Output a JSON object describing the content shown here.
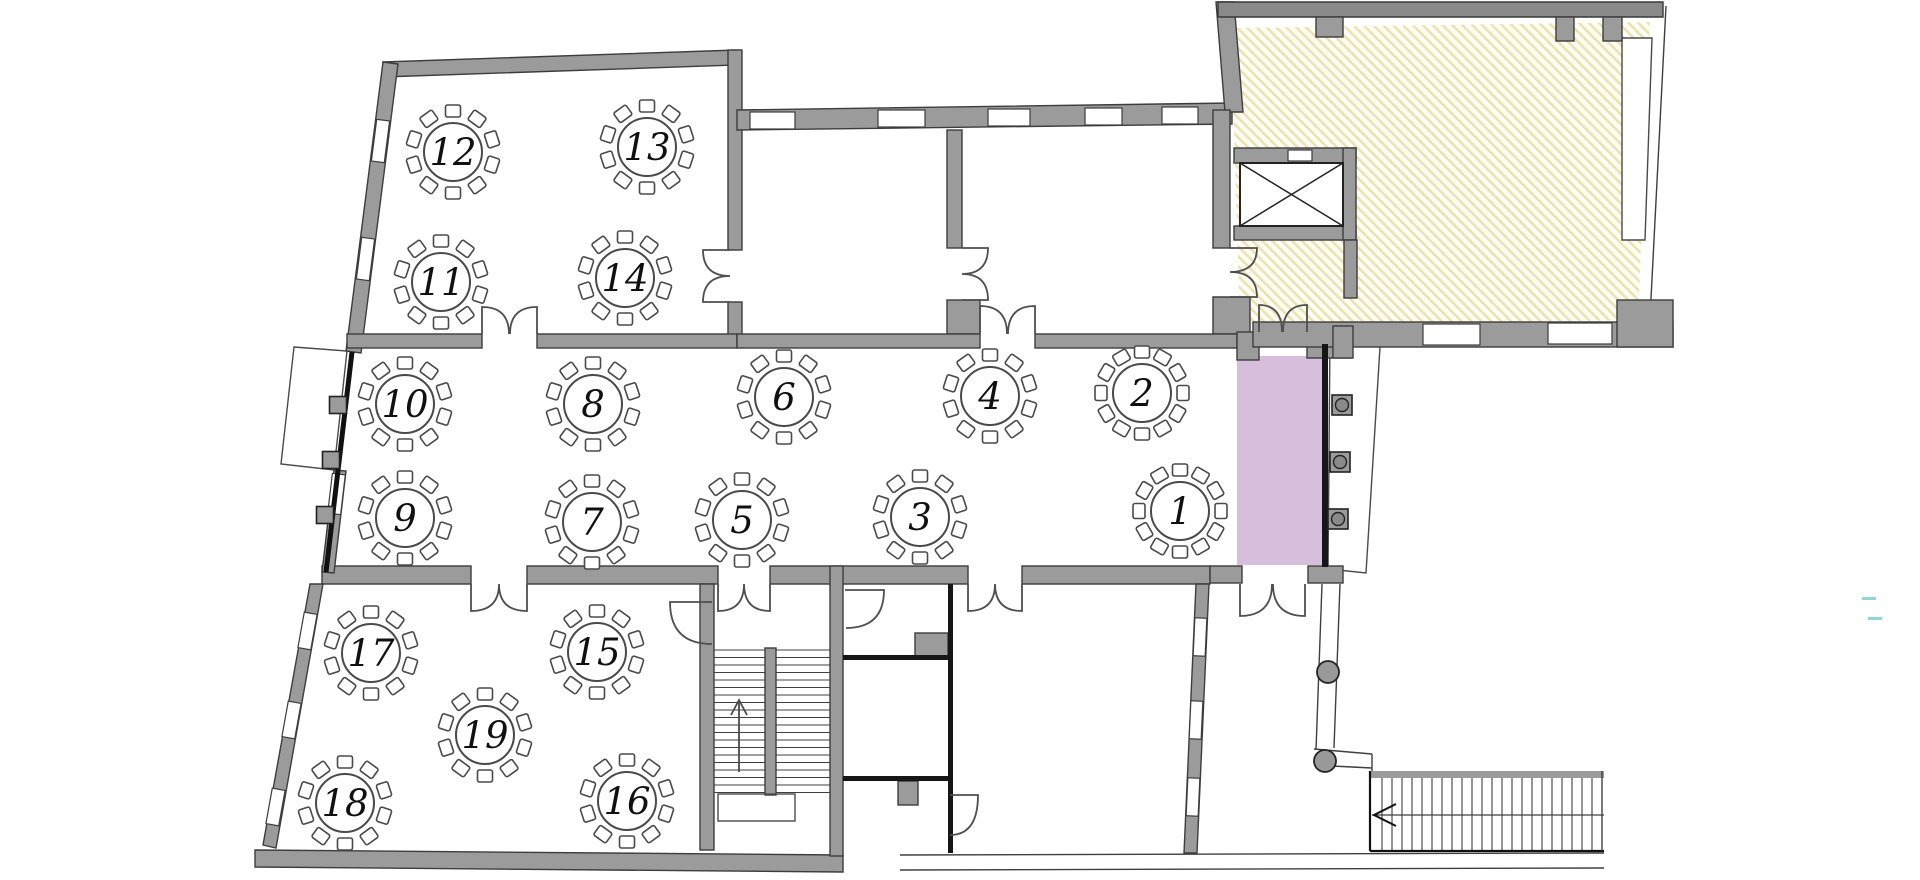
{
  "plan": {
    "tables": [
      {
        "number": "1",
        "x": 1180,
        "y": 511,
        "chairs": 12
      },
      {
        "number": "2",
        "x": 1142,
        "y": 393,
        "chairs": 12
      },
      {
        "number": "3",
        "x": 920,
        "y": 517,
        "chairs": 10
      },
      {
        "number": "4",
        "x": 990,
        "y": 396,
        "chairs": 10
      },
      {
        "number": "5",
        "x": 742,
        "y": 520,
        "chairs": 10
      },
      {
        "number": "6",
        "x": 784,
        "y": 397,
        "chairs": 10
      },
      {
        "number": "7",
        "x": 592,
        "y": 522,
        "chairs": 10
      },
      {
        "number": "8",
        "x": 593,
        "y": 404,
        "chairs": 10
      },
      {
        "number": "9",
        "x": 405,
        "y": 518,
        "chairs": 10
      },
      {
        "number": "10",
        "x": 405,
        "y": 404,
        "chairs": 10
      },
      {
        "number": "11",
        "x": 441,
        "y": 282,
        "chairs": 10
      },
      {
        "number": "12",
        "x": 453,
        "y": 152,
        "chairs": 10
      },
      {
        "number": "13",
        "x": 647,
        "y": 147,
        "chairs": 10
      },
      {
        "number": "14",
        "x": 625,
        "y": 278,
        "chairs": 10
      },
      {
        "number": "15",
        "x": 597,
        "y": 652,
        "chairs": 10
      },
      {
        "number": "16",
        "x": 627,
        "y": 801,
        "chairs": 10
      },
      {
        "number": "17",
        "x": 371,
        "y": 653,
        "chairs": 10
      },
      {
        "number": "18",
        "x": 345,
        "y": 803,
        "chairs": 10
      },
      {
        "number": "19",
        "x": 485,
        "y": 735,
        "chairs": 10
      }
    ],
    "highlight_zone": {
      "color": "#d8bedd"
    },
    "colors": {
      "wall": "#9b9b9b",
      "wall_outline": "#3d3d3d",
      "hatch_stripe": "#ece3b2",
      "hatch_bg": "#fffdf4",
      "stage_highlight": "#d8bedd",
      "artifact_mark": "#8fd9d4"
    }
  }
}
